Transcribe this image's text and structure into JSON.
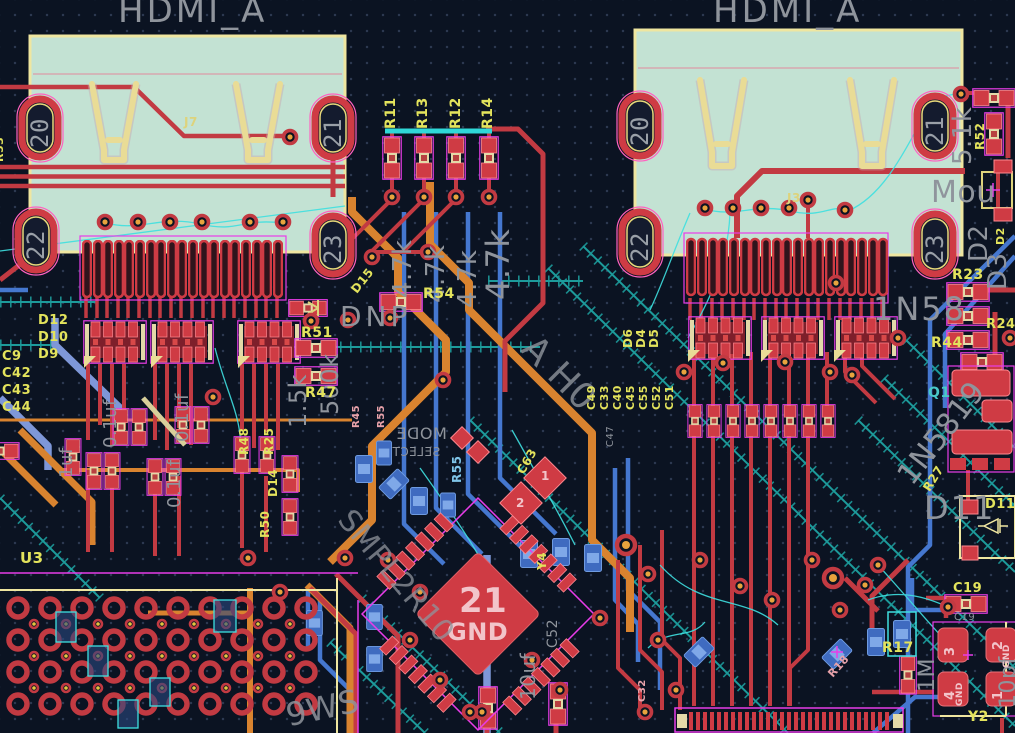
{
  "colors": {
    "background": "#0b1322",
    "copper_top": "#c23a42",
    "copper_bottom": "#4577cf",
    "copper_inner": "#d9832f",
    "ratsnest": "#3fe0e0",
    "zone_outline": "#1d9b9b",
    "silkscreen": "#efe6a0",
    "courtyard": "#e83ce8",
    "reference_text": "#e3e35c",
    "fab_text": "#8f949c",
    "connector_body": "#c3e2d3",
    "via_center": "#e8a33d"
  },
  "connectors": {
    "left": {
      "title": "HDMI_A",
      "ref": "J7",
      "pads": {
        "p20": "20",
        "p21": "21",
        "p22": "22",
        "p23": "23"
      }
    },
    "right": {
      "title": "HDMI_A",
      "ref": "J3",
      "pads": {
        "p20": "20",
        "p21": "21",
        "p22": "22",
        "p23": "23"
      }
    }
  },
  "qfn": {
    "pad_number": "21",
    "pad_name": "GND",
    "pin1": "1",
    "pin2": "2"
  },
  "crystal": {
    "p1": "1",
    "p2": "2",
    "p3": "3",
    "p4": "4",
    "gnd": "GND"
  },
  "labels": {
    "r53": "R53",
    "r11": "R11",
    "r13": "R13",
    "r12": "R12",
    "r14": "R14",
    "val_4k7": "4.7k",
    "d15": "D15",
    "r54": "R54",
    "dnp": "DNP",
    "r51": "R51",
    "val_500k": "500k",
    "val_1k5": "1.5k",
    "r47": "R47",
    "d12": "D12",
    "d10": "D10",
    "d9": "D9",
    "c9": "C9",
    "c42": "C42",
    "c43": "C43",
    "c44": "C44",
    "val_0u1": "0.1uf",
    "val_1u": "1uf",
    "r48": "R48",
    "r25": "R25",
    "r50": "R50",
    "d14": "D14",
    "u3": "U3",
    "mode": "MODE",
    "select": "SELECT",
    "r55": "R55",
    "c63": "C63",
    "y4": "Y4",
    "c52": "C52",
    "c47": "C47",
    "val_10u": "10uf",
    "d6": "D6",
    "d4": "D4",
    "d5": "D5",
    "c49": "C49",
    "c33": "C33",
    "c40": "C40",
    "c45": "C45",
    "c55": "C55",
    "c52b": "C52",
    "c51": "C51",
    "r52": "R52",
    "val_5k1": "5.1k",
    "mounting": "Mou",
    "d2_ref": "D2",
    "d2_fab": "D2",
    "d3_fab": "D3",
    "r23": "R23",
    "part_1n58": "1N58",
    "r24": "R24",
    "r44": "R44",
    "q1": "Q1",
    "part_1n5819": "1N5819",
    "r27": "R27",
    "d11_fab": "D11",
    "d11_ref": "D11",
    "r17": "R17",
    "c19_ref": "C19",
    "c19_fab": "C19",
    "y2": "Y2",
    "val_1m": "1M",
    "val_10pf": "10pf",
    "r18": "R18",
    "c32": "C32",
    "r45": "R45",
    "r55b": "R55",
    "fab_diag_a": "A H0",
    "fab_diag_b": "SMPL2R10",
    "fab_diag_c": "9WS"
  }
}
